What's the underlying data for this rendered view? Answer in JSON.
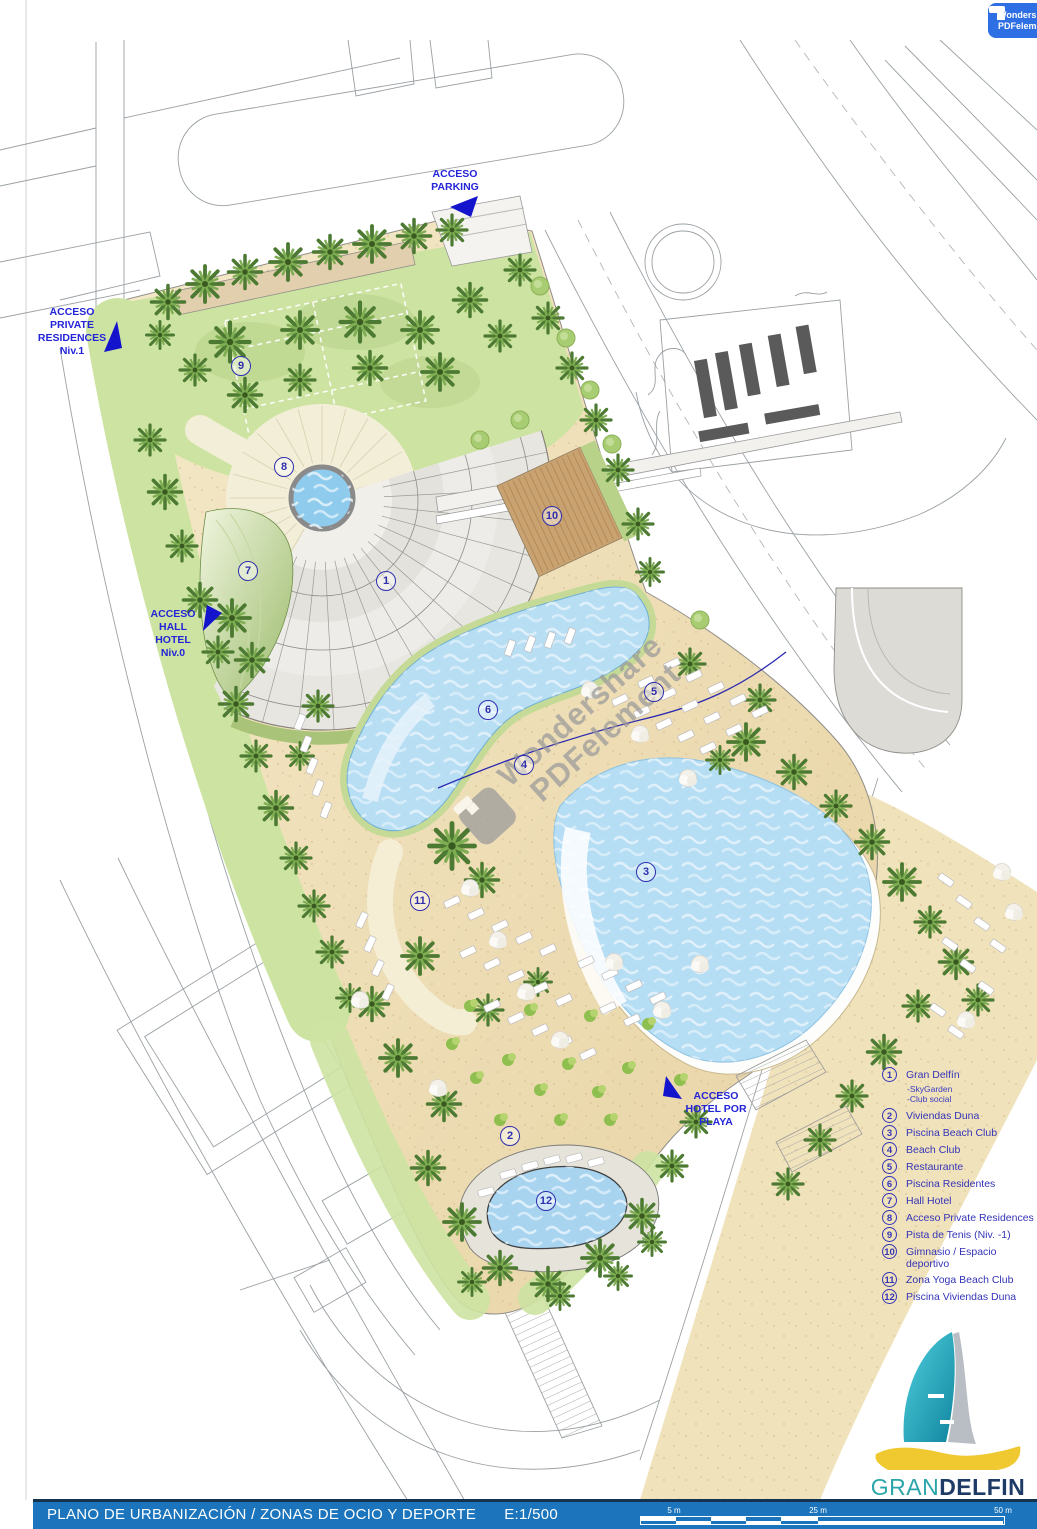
{
  "plan": {
    "access_labels": [
      {
        "id": "parking",
        "lines": [
          "ACCESO",
          "PARKING"
        ],
        "x": 455,
        "y": 168
      },
      {
        "id": "private-residences",
        "lines": [
          "ACCESO",
          "PRIVATE",
          "RESIDENCES",
          "Niv.1"
        ],
        "x": 72,
        "y": 306
      },
      {
        "id": "hall-hotel",
        "lines": [
          "ACCESO",
          "HALL",
          "HOTEL",
          "Niv.0"
        ],
        "x": 173,
        "y": 608
      },
      {
        "id": "hotel-playa",
        "lines": [
          "ACCESO",
          "HOTEL POR",
          "PLAYA"
        ],
        "x": 716,
        "y": 1090
      }
    ],
    "markers": [
      {
        "n": "1",
        "x": 386,
        "y": 581
      },
      {
        "n": "2",
        "x": 510,
        "y": 1136
      },
      {
        "n": "3",
        "x": 646,
        "y": 872
      },
      {
        "n": "4",
        "x": 524,
        "y": 765
      },
      {
        "n": "5",
        "x": 654,
        "y": 692
      },
      {
        "n": "6",
        "x": 488,
        "y": 710
      },
      {
        "n": "7",
        "x": 248,
        "y": 571
      },
      {
        "n": "8",
        "x": 284,
        "y": 467
      },
      {
        "n": "9",
        "x": 241,
        "y": 366
      },
      {
        "n": "10",
        "x": 552,
        "y": 516
      },
      {
        "n": "11",
        "x": 420,
        "y": 901
      },
      {
        "n": "12",
        "x": 546,
        "y": 1201
      }
    ]
  },
  "legend": {
    "items": [
      {
        "n": "1",
        "label": "Gran Delfín",
        "subs": [
          "-SkyGarden",
          "-Club social"
        ]
      },
      {
        "n": "2",
        "label": "Viviendas Duna",
        "subs": []
      },
      {
        "n": "3",
        "label": "Piscina Beach Club",
        "subs": []
      },
      {
        "n": "4",
        "label": "Beach Club",
        "subs": []
      },
      {
        "n": "5",
        "label": "Restaurante",
        "subs": []
      },
      {
        "n": "6",
        "label": "Piscina Residentes",
        "subs": []
      },
      {
        "n": "7",
        "label": "Hall Hotel",
        "subs": []
      },
      {
        "n": "8",
        "label": "Acceso Private Residences",
        "subs": []
      },
      {
        "n": "9",
        "label": "Pista de Tenis (Niv. -1)",
        "subs": []
      },
      {
        "n": "10",
        "label": "Gimnasio / Espacio deportivo",
        "subs": []
      },
      {
        "n": "11",
        "label": "Zona Yoga Beach Club",
        "subs": []
      },
      {
        "n": "12",
        "label": "Piscina Viviendas Duna",
        "subs": []
      }
    ]
  },
  "watermark": {
    "line1": "Wondershare",
    "line2": "PDFelement"
  },
  "footer": {
    "title": "PLANO DE URBANIZACIÓN / ZONAS DE OCIO Y DEPORTE",
    "scale_text": "E:1/500",
    "scale_ticks": [
      "5 m",
      "25 m",
      "50 m"
    ]
  },
  "logo": {
    "name_part1": "GRAN",
    "name_part2": "DELFIN",
    "tagline": "PRIVATE RESIDENCES & HOTEL"
  },
  "colors": {
    "accent_blue": "#2f2fae",
    "arrow_blue": "#1414cc",
    "footer_blue": "#1b74bc",
    "pool_blue": "#b8def4",
    "sand": "#eedcb0",
    "lawn_green": "#cde3a2",
    "palm_green": "#4c7a32",
    "logo_teal": "#2aa6ab",
    "logo_navy": "#1e3a66",
    "badge_blue": "#2e6fe3"
  }
}
